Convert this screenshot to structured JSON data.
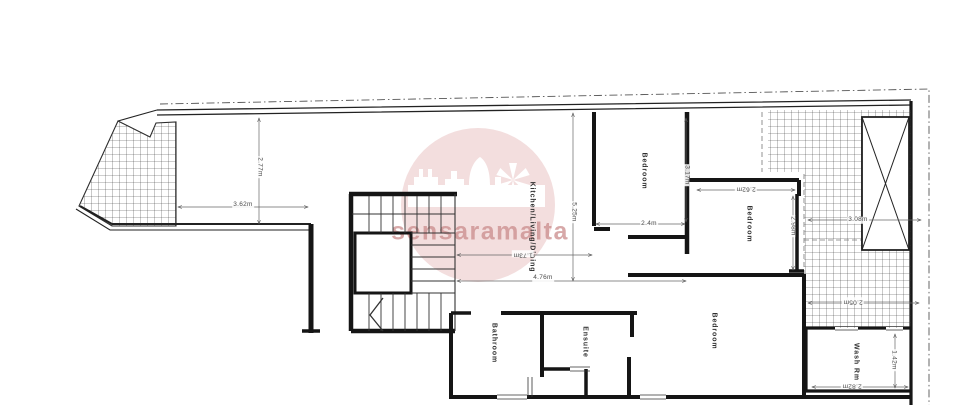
{
  "page": {
    "background": "#ffffff",
    "description": "architectural floor plan drawing"
  },
  "watermark": {
    "brand": "sensaramalta",
    "emblem": "castle-skyline-and-windmill",
    "circle_color": "#f1dada",
    "text_color": "#c98b8b"
  },
  "rooms": [
    {
      "label": "Kitchen/Living/Dining"
    },
    {
      "label": "Bedroom"
    },
    {
      "label": "Bedroom"
    },
    {
      "label": "Bedroom"
    },
    {
      "label": "Bathroom"
    },
    {
      "label": "Ensuite"
    },
    {
      "label": "Wash Rm"
    }
  ],
  "dimensions": [
    {
      "label": "3.62m"
    },
    {
      "label": "2.77m"
    },
    {
      "label": "5.25m"
    },
    {
      "label": "1.73m"
    },
    {
      "label": "4.76m"
    },
    {
      "label": "2.4m"
    },
    {
      "label": "3.17m"
    },
    {
      "label": "2.62m"
    },
    {
      "label": "2.98m"
    },
    {
      "label": "3.08m"
    },
    {
      "label": "2.05m"
    },
    {
      "label": "1.42m"
    },
    {
      "label": "2.82m"
    }
  ],
  "drawing_features": {
    "staircase": "u-shaped-stair-with-lift",
    "shaft": "crossed-void-shaft",
    "terraces": "grid-hatched-areas",
    "boundary": "dash-dot-site-boundary"
  }
}
